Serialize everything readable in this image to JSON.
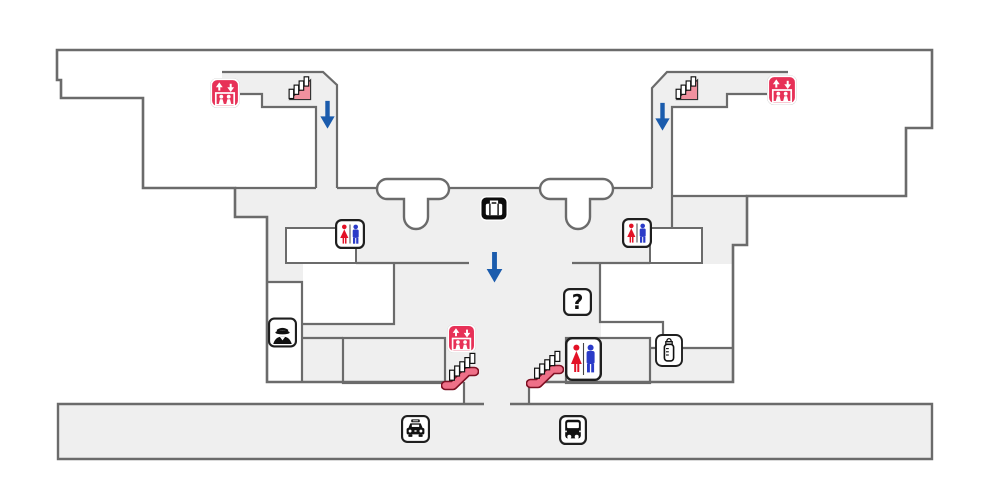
{
  "map": {
    "kind": "airport-terminal-floor-map",
    "question_mark": "?",
    "colors": {
      "wall": "#6b6b6b",
      "floor": "#efefef",
      "white": "#ffffff",
      "ink": "#111111",
      "elevator_crimson": "#e73157",
      "stairs_pink": "#f0919f",
      "escalator_rail": "#ef7088",
      "escalator_rail_dark": "#7d1023",
      "arrow_blue": "#1b5cad",
      "toilet_red": "#e31126",
      "toilet_blue": "#2b3bc8"
    },
    "icons": [
      {
        "name": "elevator-northwest-icon",
        "type": "elevator",
        "x": 210,
        "y": 78,
        "w": 30,
        "h": 30
      },
      {
        "name": "stairs-northwest-icon",
        "type": "stairs",
        "x": 287,
        "y": 74,
        "w": 26,
        "h": 28
      },
      {
        "name": "down-arrow-west-icon",
        "type": "arrow-down",
        "x": 320,
        "y": 100,
        "w": 15,
        "h": 30
      },
      {
        "name": "toilet-northwest-icon",
        "type": "toilet",
        "x": 335,
        "y": 219,
        "w": 30,
        "h": 30
      },
      {
        "name": "baggage-claim-icon",
        "type": "baggage",
        "x": 480,
        "y": 196,
        "w": 28,
        "h": 25
      },
      {
        "name": "toilet-northeast-icon",
        "type": "toilet",
        "x": 622,
        "y": 218,
        "w": 30,
        "h": 30
      },
      {
        "name": "stairs-northeast-icon",
        "type": "stairs",
        "x": 674,
        "y": 74,
        "w": 26,
        "h": 28
      },
      {
        "name": "down-arrow-east-icon",
        "type": "arrow-down",
        "x": 655,
        "y": 102,
        "w": 15,
        "h": 30
      },
      {
        "name": "elevator-northeast-icon",
        "type": "elevator",
        "x": 767,
        "y": 75,
        "w": 30,
        "h": 30
      },
      {
        "name": "down-arrow-center-icon",
        "type": "arrow-down",
        "x": 486,
        "y": 252,
        "w": 17,
        "h": 31
      },
      {
        "name": "information-icon",
        "type": "question",
        "x": 563,
        "y": 288,
        "w": 29,
        "h": 28
      },
      {
        "name": "police-icon",
        "type": "police",
        "x": 268,
        "y": 317,
        "w": 29,
        "h": 31
      },
      {
        "name": "elevator-center-icon",
        "type": "elevator",
        "x": 447,
        "y": 324,
        "w": 29,
        "h": 29
      },
      {
        "name": "escalator-west-icon",
        "type": "escalator",
        "x": 441,
        "y": 349,
        "w": 38,
        "h": 43
      },
      {
        "name": "escalator-east-icon",
        "type": "escalator",
        "x": 526,
        "y": 347,
        "w": 38,
        "h": 43
      },
      {
        "name": "toilet-central-icon",
        "type": "toilet-large",
        "x": 565,
        "y": 337,
        "w": 37,
        "h": 44
      },
      {
        "name": "nursing-room-icon",
        "type": "nursing",
        "x": 655,
        "y": 334,
        "w": 28,
        "h": 33
      },
      {
        "name": "taxi-stand-icon",
        "type": "taxi",
        "x": 401,
        "y": 414,
        "w": 29,
        "h": 30
      },
      {
        "name": "bus-stop-icon",
        "type": "bus",
        "x": 559,
        "y": 415,
        "w": 28,
        "h": 30
      }
    ]
  }
}
